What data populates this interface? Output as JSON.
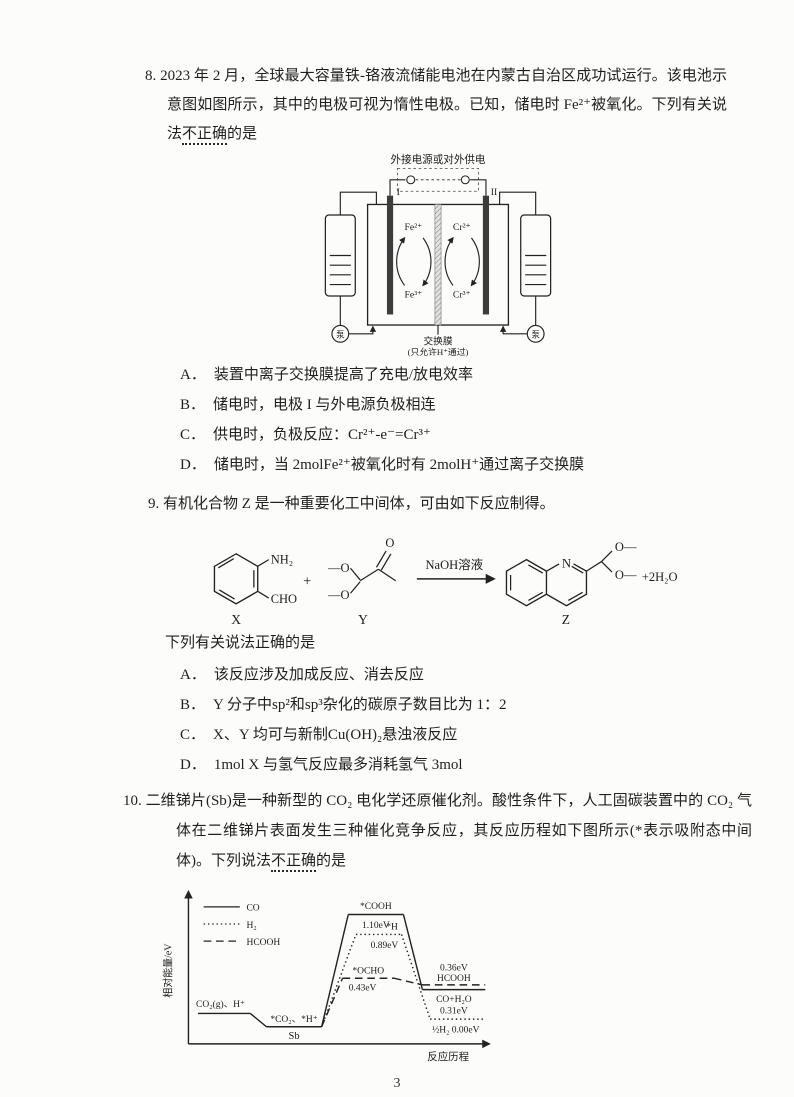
{
  "colors": {
    "paper": "#fcfcfb",
    "ink": "#1f1f1f"
  },
  "page": {
    "number": "3"
  },
  "q8": {
    "stem_before": "8. 2023 年 2 月，全球最大容量铁-铬液流储能电池在内蒙古自治区成功试运行。该电池示意图如图所示，其中的电极可视为惰性电极。已知，储电时 Fe²⁺被氧化。下列有关说法",
    "stem_emph": "不正确",
    "stem_after": "的是",
    "diagram": {
      "top_label": "外接电源或对外供电",
      "electrode_left": "I",
      "electrode_right": "II",
      "left_top_ion": "Fe²⁺",
      "left_bottom_ion": "Fe³⁺",
      "right_top_ion": "Cr²⁺",
      "right_bottom_ion": "Cr³⁺",
      "pump_left": "泵",
      "pump_right": "泵",
      "membrane_label": "交换膜",
      "membrane_note": "(只允许H⁺通过)"
    },
    "options": [
      {
        "label": "A．",
        "text": "装置中离子交换膜提高了充电/放电效率"
      },
      {
        "label": "B．",
        "text": "储电时，电极 I 与外电源负极相连"
      },
      {
        "label": "C．",
        "text": "供电时，负极反应：Cr²⁺-e⁻=Cr³⁺"
      },
      {
        "label": "D．",
        "text": "储电时，当 2molFe²⁺被氧化时有 2molH⁺通过离子交换膜"
      }
    ]
  },
  "q9": {
    "stem": "9. 有机化合物 Z 是一种重要化工中间体，可由如下反应制得。",
    "scheme": {
      "x_nh2": "NH₂",
      "x_cho": "CHO",
      "plus": "+",
      "y_methoxy_top": "—O",
      "y_methoxy_bottom": "—O",
      "y_carbonyl_o": "O",
      "reagent": "NaOH溶液",
      "z_n": "N",
      "z_o_top": "O—",
      "z_o_bottom": "O—",
      "water": "+2H₂O",
      "label_x": "X",
      "label_y": "Y",
      "label_z": "Z"
    },
    "lead": "下列有关说法正确的是",
    "options": [
      {
        "label": "A．",
        "text": "该反应涉及加成反应、消去反应"
      },
      {
        "label": "B．",
        "text": "Y 分子中sp²和sp³杂化的碳原子数目比为 1：2"
      },
      {
        "label": "C．",
        "text": "X、Y 均可与新制Cu(OH)₂悬浊液反应"
      },
      {
        "label": "D．",
        "text": "1mol X 与氢气反应最多消耗氢气 3mol"
      }
    ]
  },
  "q10": {
    "stem_before": "10. 二维锑片(Sb)是一种新型的 CO₂ 电化学还原催化剂。酸性条件下，人工固碳装置中的 CO₂ 气体在二维锑片表面发生三种催化竞争反应，其反应历程如下图所示(*表示吸附态中间体)。下列说法",
    "stem_emph": "不正确",
    "stem_after": "的是",
    "diagram": {
      "ylabel": "相对能量/eV",
      "xlabel": "反应历程",
      "legend_co": "CO",
      "legend_h2": "H₂",
      "legend_hcooh": "HCOOH",
      "start": "CO₂(g)、H⁺",
      "adsorbed": "*CO₂、*H⁺",
      "catalyst": "Sb",
      "peak_co": "*COOH",
      "peak_co_ev": "1.10eV",
      "peak_h2": "*H",
      "peak_h2_ev": "0.89eV",
      "peak_hcooh": "*OCHO",
      "peak_hcooh_ev": "0.43eV",
      "final_hcooh_ev": "0.36eV",
      "final_hcooh": "HCOOH",
      "final_co": "CO+H₂O",
      "final_co_ev": "0.31eV",
      "final_h2": "½H₂ 0.00eV"
    }
  },
  "chart_data": {
    "type": "line",
    "title": "",
    "xlabel": "反应历程",
    "ylabel": "相对能量/eV",
    "legend_position": "upper left",
    "legend": [
      "CO",
      "H₂",
      "HCOOH"
    ],
    "annotations": [
      "Sb",
      "*表示吸附态中间体"
    ],
    "series": [
      {
        "name": "CO",
        "style": "solid",
        "stages": [
          {
            "label": "CO₂(g)、H⁺",
            "eV": 0.05
          },
          {
            "label": "*CO₂、*H⁺",
            "eV": -0.1
          },
          {
            "label": "*COOH",
            "eV": 1.1
          },
          {
            "label": "CO+H₂O",
            "eV": 0.31
          }
        ]
      },
      {
        "name": "H₂",
        "style": "dotted",
        "stages": [
          {
            "label": "CO₂(g)、H⁺",
            "eV": 0.05
          },
          {
            "label": "*CO₂、*H⁺",
            "eV": -0.1
          },
          {
            "label": "*H",
            "eV": 0.89
          },
          {
            "label": "½H₂",
            "eV": 0.0
          }
        ]
      },
      {
        "name": "HCOOH",
        "style": "dashed",
        "stages": [
          {
            "label": "CO₂(g)、H⁺",
            "eV": 0.05
          },
          {
            "label": "*CO₂、*H⁺",
            "eV": -0.1
          },
          {
            "label": "*OCHO",
            "eV": 0.43
          },
          {
            "label": "HCOOH",
            "eV": 0.36
          }
        ]
      }
    ]
  }
}
